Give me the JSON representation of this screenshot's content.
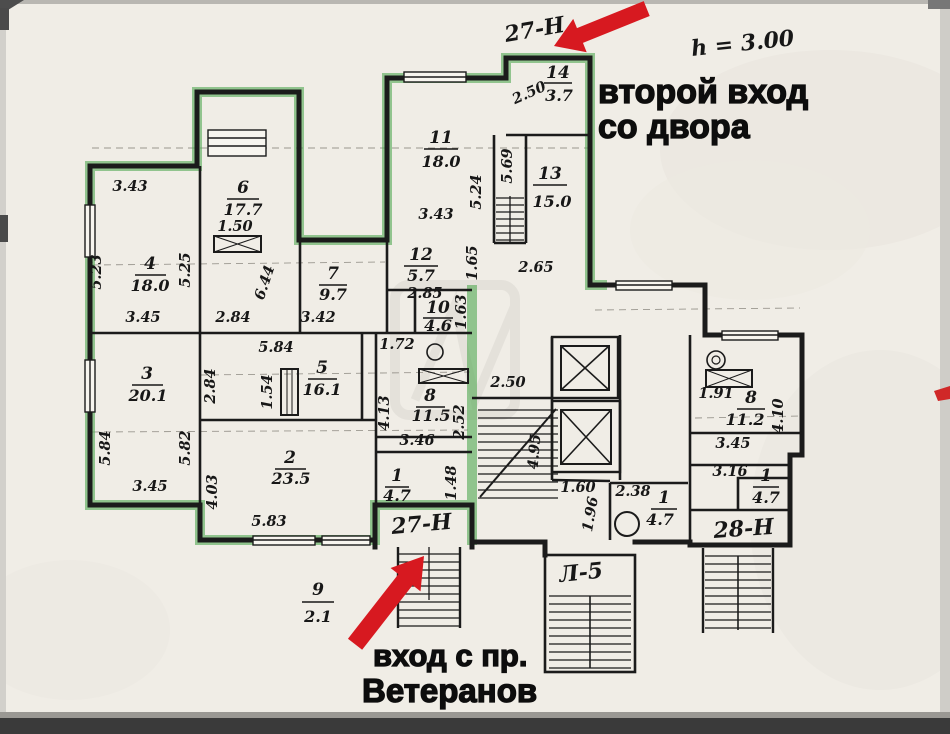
{
  "annotations": {
    "premises_top_label": "27-Н",
    "premises_bottom_label": "27-Н",
    "premises_right_label": "28-Н",
    "stairwell_label": "Л-5",
    "height_label": "h = 3.00",
    "entrance2_line1": "второй вход",
    "entrance2_line2": "со двора",
    "entrance1_line1": "вход с пр.",
    "entrance1_line2": "Ветеранов"
  },
  "rooms": [
    {
      "number": "14",
      "area": "3.7"
    },
    {
      "number": "11",
      "area": "18.0"
    },
    {
      "number": "13",
      "area": "15.0"
    },
    {
      "number": "6",
      "area": "17.7"
    },
    {
      "number": "4",
      "area": "18.0"
    },
    {
      "number": "7",
      "area": "9.7"
    },
    {
      "number": "12",
      "area": "5.7"
    },
    {
      "number": "10",
      "area": "4.6"
    },
    {
      "number": "3",
      "area": "20.1"
    },
    {
      "number": "5",
      "area": "16.1"
    },
    {
      "number": "8",
      "area": "11.5"
    },
    {
      "number": "2",
      "area": "23.5"
    },
    {
      "number": "1",
      "area": "4.7"
    },
    {
      "number": "9",
      "area": "2.1"
    },
    {
      "number": "1",
      "area": "4.7"
    },
    {
      "number": "8",
      "area": "11.2"
    },
    {
      "number": "1",
      "area": "4.7"
    }
  ],
  "dims": [
    "3.43",
    "5.23",
    "1.50",
    "3.45",
    "2.84",
    "3.42",
    "5.25",
    "6.44",
    "2.50",
    "3.43",
    "5.24",
    "5.69",
    "2.85",
    "1.65",
    "2.65",
    "1.63",
    "5.84",
    "1.54",
    "5.84",
    "5.82",
    "2.84",
    "3.45",
    "4.03",
    "5.83",
    "1.72",
    "2.50",
    "3.46",
    "4.13",
    "2.52",
    "1.48",
    "4.95",
    "1.60",
    "1.96",
    "2.38",
    "1.91",
    "3.45",
    "4.10",
    "3.16"
  ],
  "icons": {
    "arrow_top": "red-arrow-second-entrance",
    "arrow_bottom": "red-arrow-main-entrance",
    "elevator": "elevator-shaft",
    "staircase": "staircase",
    "wc_fixture": "wc-fixture",
    "vent": "ventilation-shaft"
  },
  "colors": {
    "highlight_green": "#57ab57",
    "arrow_red": "#d71920",
    "wall_black": "#1b1b1b",
    "paper": "#f0ede6"
  }
}
